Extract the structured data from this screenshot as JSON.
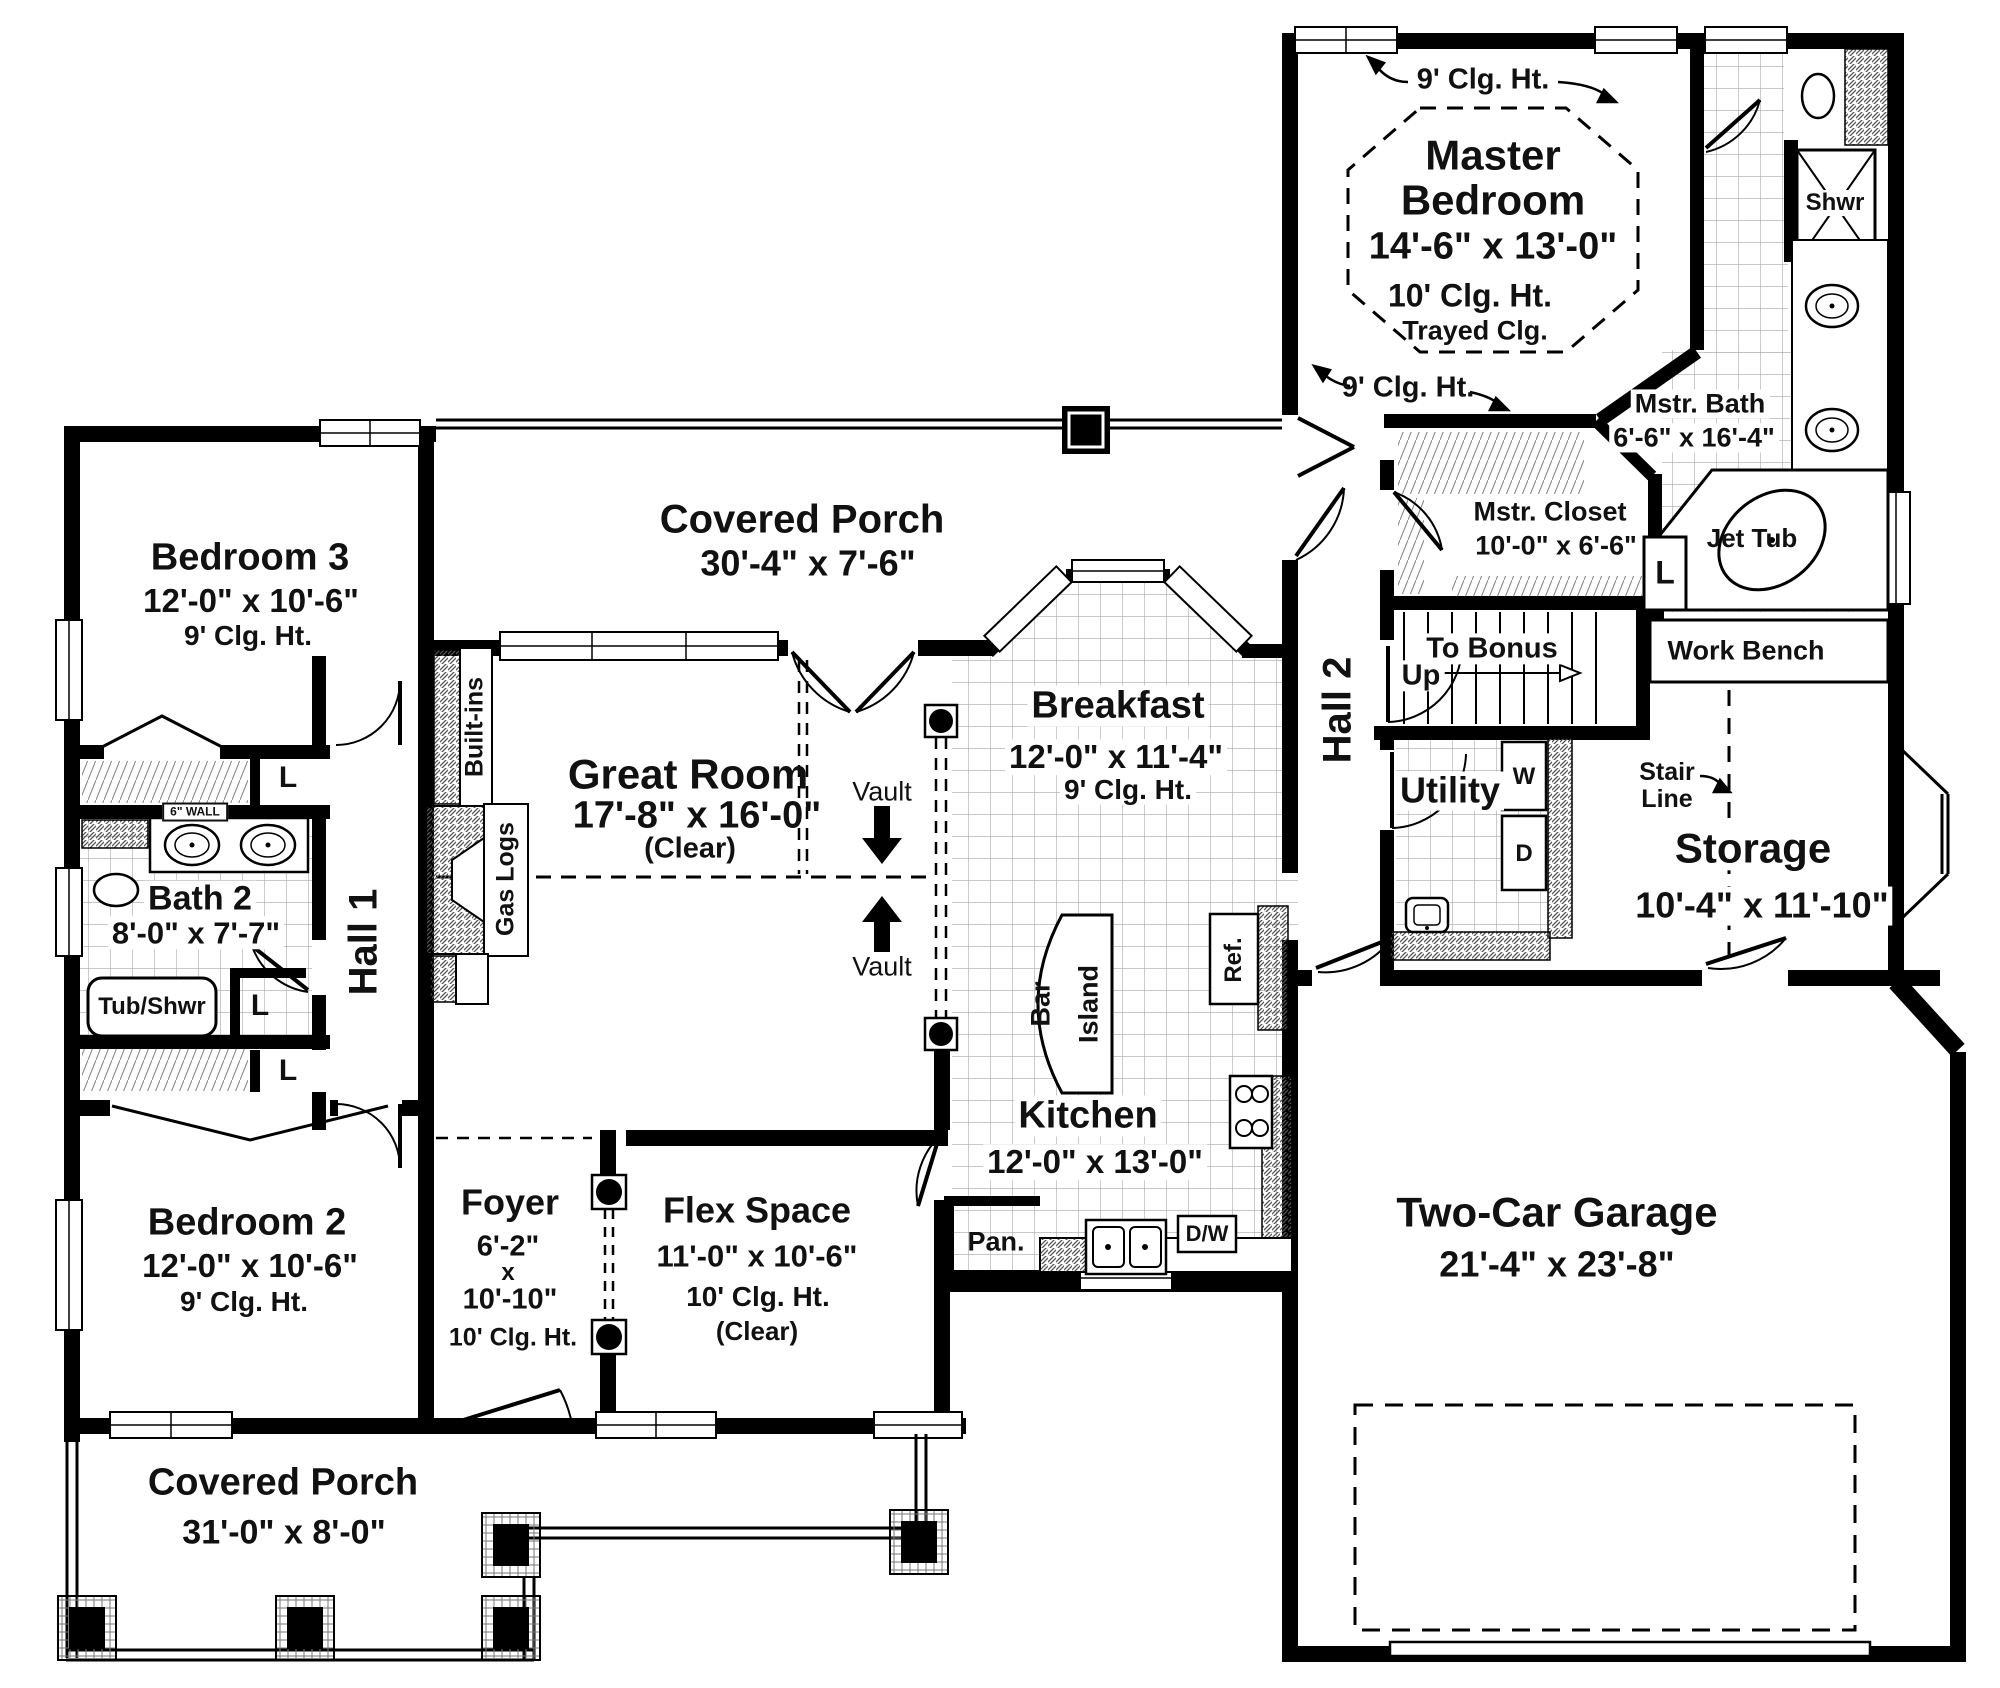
{
  "rooms": {
    "master_bedroom": {
      "name": "Master Bedroom",
      "dims": "14'-6\" x 13'-0\"",
      "clg": "10' Clg. Ht.",
      "extra": "Trayed Clg."
    },
    "mstr_bath": {
      "name": "Mstr. Bath",
      "dims": "6'-6\" x 16'-4\""
    },
    "mstr_closet": {
      "name": "Mstr. Closet",
      "dims": "10'-0\" x 6'-6\""
    },
    "hall2": {
      "name": "Hall 2"
    },
    "hall1": {
      "name": "Hall 1"
    },
    "utility": {
      "name": "Utility"
    },
    "storage": {
      "name": "Storage",
      "dims": "10'-4\" x 11'-10\""
    },
    "garage": {
      "name": "Two-Car Garage",
      "dims": "21'-4\" x 23'-8\""
    },
    "breakfast": {
      "name": "Breakfast",
      "dims": "12'-0\" x 11'-4\"",
      "clg": "9' Clg. Ht."
    },
    "kitchen": {
      "name": "Kitchen",
      "dims": "12'-0\" x 13'-0\""
    },
    "great_room": {
      "name": "Great Room",
      "dims": "17'-8\" x 16'-0\"",
      "extra": "(Clear)"
    },
    "porch_top": {
      "name": "Covered Porch",
      "dims": "30'-4\" x 7'-6\""
    },
    "porch_bottom": {
      "name": "Covered Porch",
      "dims": "31'-0\" x 8'-0\""
    },
    "bedroom3": {
      "name": "Bedroom 3",
      "dims": "12'-0\" x 10'-6\"",
      "clg": "9' Clg. Ht."
    },
    "bath2": {
      "name": "Bath 2",
      "dims": "8'-0\" x 7'-7\""
    },
    "bedroom2": {
      "name": "Bedroom 2",
      "dims": "12'-0\" x 10'-6\"",
      "clg": "9' Clg. Ht."
    },
    "foyer": {
      "name": "Foyer",
      "w": "6'-2\"",
      "x": "x",
      "l": "10'-10\"",
      "clg": "10' Clg. Ht."
    },
    "flex": {
      "name": "Flex Space",
      "dims": "11'-0\" x 10'-6\"",
      "clg": "10' Clg. Ht.",
      "extra": "(Clear)"
    }
  },
  "fixtures": {
    "shwr": "Shwr",
    "jet_tub": "Jet Tub",
    "tub_shwr": "Tub/Shwr",
    "work_bench": "Work Bench",
    "to_bonus": "To Bonus",
    "up": "Up",
    "stair_line": "Stair Line",
    "washer": "W",
    "dryer": "D",
    "linen": "L",
    "ref": "Ref.",
    "pantry": "Pan.",
    "dishwasher": "D/W",
    "bar": "Bar",
    "island": "Island",
    "built_ins": "Built-ins",
    "gas_logs": "Gas Logs",
    "vault": "Vault",
    "six_wall": "6\" WALL",
    "clg9": "9' Clg. Ht."
  },
  "colors": {
    "wall": "#000000",
    "text": "#111111",
    "tile_line": "#a8a8a8",
    "hatch": "#555555"
  }
}
